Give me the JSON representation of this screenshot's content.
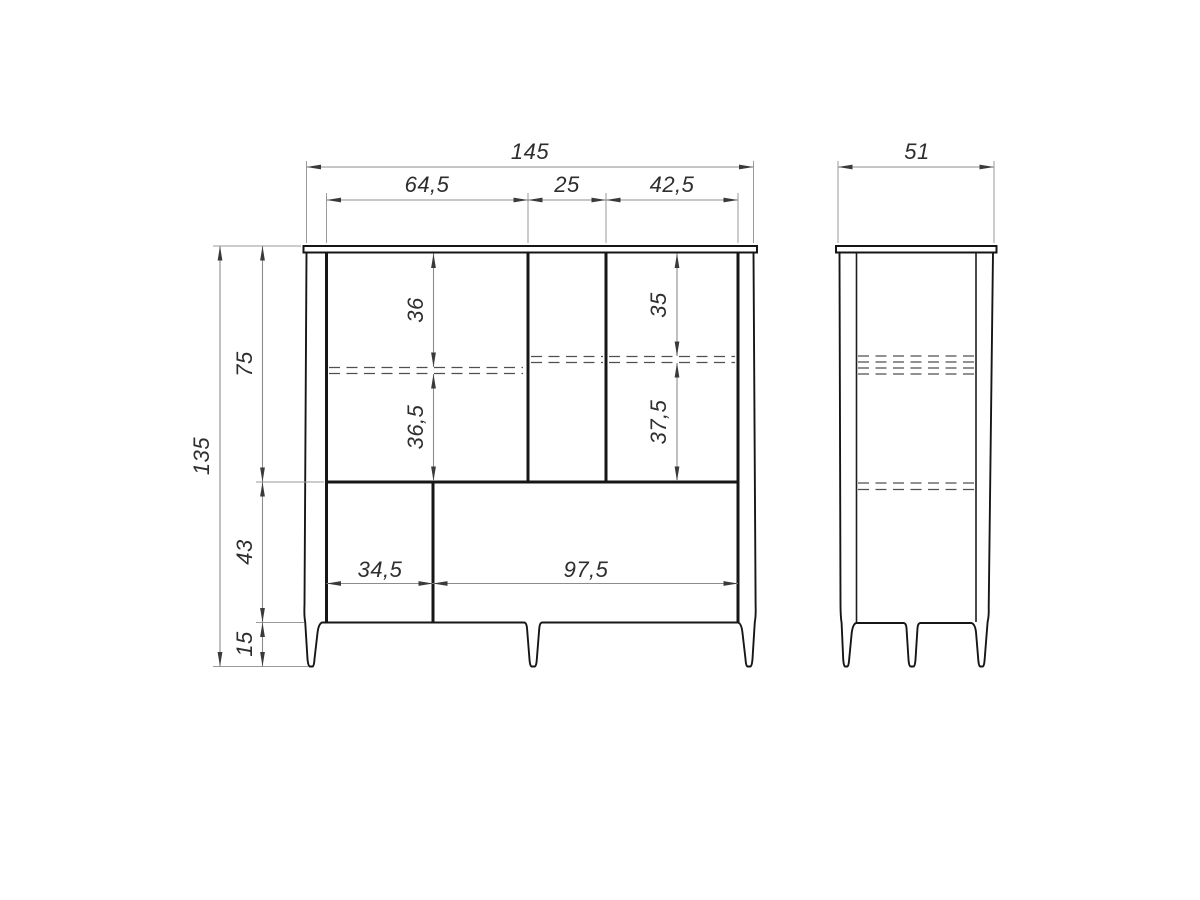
{
  "drawing": {
    "type": "furniture technical drawing",
    "views": {
      "front": {
        "name": "front-view",
        "dimensions": {
          "overall_width": "145",
          "left_section_width": "64,5",
          "center_section_width": "25",
          "right_section_width": "42,5",
          "overall_height": "135",
          "upper_carcass_height": "75",
          "lower_carcass_height": "43",
          "leg_height": "15",
          "left_shelf_top_offset": "36",
          "left_shelf_bottom_offset": "36,5",
          "right_shelf_top_offset": "35",
          "right_shelf_bottom_offset": "37,5",
          "bottom_left_compartment_width": "34,5",
          "bottom_right_compartment_width": "97,5"
        }
      },
      "side": {
        "name": "side-view",
        "dimensions": {
          "overall_depth": "51"
        }
      }
    },
    "style": {
      "background": "#ffffff",
      "object_line_color": "#161616",
      "hidden_line_color": "#4f4f4f",
      "dimension_line_color": "#8c8c8c",
      "dimension_text_color": "#2e2e2e"
    }
  }
}
